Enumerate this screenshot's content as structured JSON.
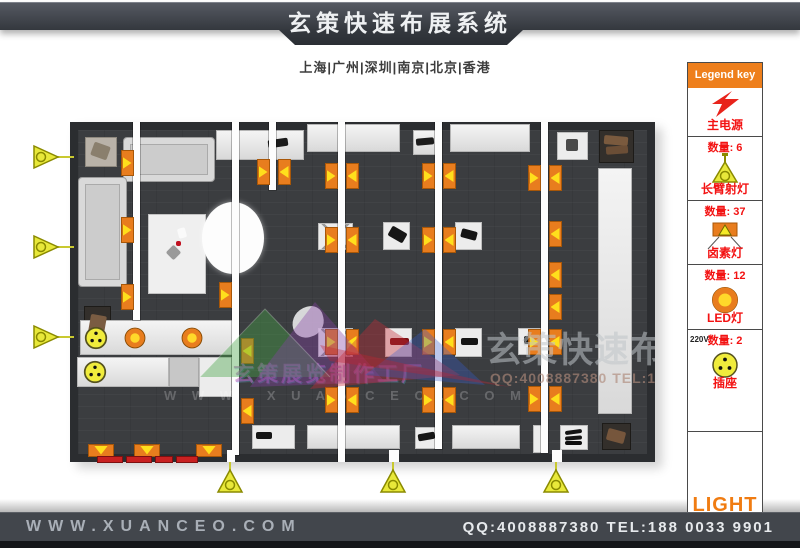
{
  "header": {
    "title": "玄策快速布展系统"
  },
  "subtitle": {
    "cities": "上海|广州|深圳|南京|北京|香港"
  },
  "legend": {
    "title": "Legend key",
    "items": [
      {
        "label": "主电源",
        "icon": "lightning-icon"
      },
      {
        "count": "数量: 6",
        "label": "长臂射灯",
        "icon": "long-arm-spotlight-icon"
      },
      {
        "count": "数量: 37",
        "label": "卤素灯",
        "icon": "halogen-lamp-icon"
      },
      {
        "count": "数量: 12",
        "label": "LED灯",
        "icon": "led-lamp-icon"
      },
      {
        "count": "数量: 2",
        "voltage": "220V",
        "label": "插座",
        "icon": "socket-icon"
      }
    ],
    "footer_label": "LIGHT"
  },
  "watermarks": {
    "studio": "玄策展览制作工厂",
    "url_letters": "W W W . X U A N C E O . C O M",
    "title": "玄策快速布展系统",
    "contact": "QQ:4008887380 TEL:188 003"
  },
  "footer": {
    "website": "WWW.XUANCEO.COM",
    "contact": "QQ:4008887380 TEL:188 0033 9901"
  },
  "colors": {
    "accent_orange": "#ee7f1c",
    "marker_orange": "#e87d1e",
    "marker_yellow": "#ffdf1c",
    "legend_red": "#f31212",
    "bar_dark": "#42464c"
  },
  "plan": {
    "origin": [
      70,
      122
    ],
    "strips": [
      [
        133,
        122,
        7,
        198
      ],
      [
        232,
        122,
        7,
        333
      ],
      [
        269,
        122,
        7,
        68
      ],
      [
        338,
        122,
        7,
        340
      ],
      [
        435,
        122,
        7,
        327
      ],
      [
        541,
        122,
        7,
        331
      ]
    ],
    "halogen_markers": [
      [
        127,
        163,
        "R"
      ],
      [
        127,
        230,
        "R"
      ],
      [
        127,
        297,
        "R"
      ],
      [
        263,
        172,
        "R"
      ],
      [
        284,
        172,
        "L"
      ],
      [
        225,
        295,
        "R"
      ],
      [
        247,
        351,
        "L"
      ],
      [
        247,
        411,
        "L"
      ],
      [
        331,
        176,
        "R"
      ],
      [
        352,
        176,
        "L"
      ],
      [
        331,
        240,
        "R"
      ],
      [
        352,
        240,
        "L"
      ],
      [
        331,
        342,
        "R"
      ],
      [
        352,
        342,
        "L"
      ],
      [
        331,
        400,
        "R"
      ],
      [
        352,
        400,
        "L"
      ],
      [
        428,
        176,
        "R"
      ],
      [
        449,
        176,
        "L"
      ],
      [
        428,
        240,
        "R"
      ],
      [
        449,
        240,
        "L"
      ],
      [
        428,
        342,
        "R"
      ],
      [
        449,
        342,
        "L"
      ],
      [
        428,
        400,
        "R"
      ],
      [
        449,
        400,
        "L"
      ],
      [
        534,
        178,
        "R"
      ],
      [
        555,
        178,
        "L"
      ],
      [
        555,
        234,
        "L"
      ],
      [
        555,
        275,
        "L"
      ],
      [
        555,
        307,
        "L"
      ],
      [
        534,
        342,
        "R"
      ],
      [
        555,
        342,
        "L"
      ],
      [
        534,
        399,
        "R"
      ],
      [
        555,
        399,
        "L"
      ],
      [
        101,
        450,
        "D"
      ],
      [
        147,
        450,
        "D"
      ],
      [
        209,
        450,
        "D"
      ]
    ],
    "furniture": [
      {
        "t": "counter",
        "r": [
          216,
          130,
          88,
          30
        ]
      },
      {
        "t": "counter",
        "r": [
          307,
          124,
          93,
          28
        ]
      },
      {
        "t": "counter",
        "r": [
          413,
          130,
          24,
          25
        ]
      },
      {
        "t": "counter",
        "r": [
          450,
          124,
          80,
          28
        ]
      },
      {
        "t": "white",
        "r": [
          557,
          132,
          31,
          28
        ]
      },
      {
        "t": "dark",
        "r": [
          599,
          130,
          35,
          33
        ]
      },
      {
        "t": "gray",
        "r": [
          85,
          137,
          32,
          30
        ]
      },
      {
        "t": "sofa",
        "r": [
          123,
          137,
          92,
          45
        ]
      },
      {
        "t": "sofa",
        "r": [
          78,
          177,
          49,
          110
        ]
      },
      {
        "t": "dark",
        "r": [
          84,
          306,
          27,
          44
        ]
      },
      {
        "t": "mat",
        "r": [
          148,
          214,
          58,
          80
        ]
      },
      {
        "t": "counter",
        "r": [
          598,
          168,
          34,
          246
        ]
      },
      {
        "t": "pedx",
        "r": [
          318,
          223,
          35,
          27
        ]
      },
      {
        "t": "white",
        "r": [
          383,
          222,
          27,
          28
        ]
      },
      {
        "t": "white",
        "r": [
          455,
          222,
          27,
          28
        ]
      },
      {
        "t": "pedx",
        "r": [
          318,
          328,
          35,
          29
        ]
      },
      {
        "t": "white",
        "r": [
          385,
          328,
          27,
          29
        ]
      },
      {
        "t": "white",
        "r": [
          455,
          328,
          27,
          29
        ]
      },
      {
        "t": "white",
        "r": [
          518,
          328,
          27,
          27
        ]
      },
      {
        "t": "counter",
        "r": [
          80,
          320,
          153,
          35
        ]
      },
      {
        "t": "counter",
        "r": [
          77,
          357,
          92,
          30
        ]
      },
      {
        "t": "lgray",
        "r": [
          169,
          357,
          30,
          30
        ]
      },
      {
        "t": "white",
        "r": [
          199,
          357,
          33,
          40
        ]
      },
      {
        "t": "white",
        "r": [
          252,
          425,
          43,
          24
        ]
      },
      {
        "t": "counter",
        "r": [
          307,
          425,
          93,
          24
        ]
      },
      {
        "t": "white",
        "r": [
          415,
          427,
          25,
          22
        ]
      },
      {
        "t": "counter",
        "r": [
          452,
          425,
          68,
          24
        ]
      },
      {
        "t": "white",
        "r": [
          533,
          425,
          15,
          28
        ]
      },
      {
        "t": "white",
        "r": [
          560,
          425,
          28,
          25
        ]
      },
      {
        "t": "dark",
        "r": [
          602,
          423,
          29,
          27
        ]
      }
    ],
    "items": [
      [
        268,
        139,
        20,
        8,
        -8,
        "#1c1c1c"
      ],
      [
        416,
        138,
        18,
        7,
        -5,
        "#1c1c1c"
      ],
      [
        92,
        144,
        17,
        14,
        20,
        "#8a7f6d"
      ],
      [
        89,
        315,
        16,
        24,
        10,
        "#7a5c42"
      ],
      [
        604,
        136,
        24,
        9,
        5,
        "#7a5a3e"
      ],
      [
        606,
        146,
        22,
        8,
        -4,
        "#6b4e36"
      ],
      [
        566,
        139,
        12,
        12,
        0,
        "#4a4a4a"
      ],
      [
        389,
        229,
        17,
        11,
        30,
        "#161616"
      ],
      [
        461,
        230,
        16,
        9,
        15,
        "#161616"
      ],
      [
        524,
        336,
        16,
        8,
        0,
        "#161616"
      ],
      [
        390,
        338,
        19,
        7,
        0,
        "#7a1216"
      ],
      [
        461,
        338,
        17,
        7,
        0,
        "#161616"
      ],
      [
        256,
        432,
        16,
        7,
        0,
        "#161616"
      ],
      [
        418,
        433,
        17,
        7,
        -10,
        "#161616"
      ],
      [
        565,
        430,
        17,
        4,
        -8,
        "#141414"
      ],
      [
        565,
        436,
        17,
        4,
        -4,
        "#141414"
      ],
      [
        565,
        441,
        17,
        4,
        0,
        "#0e0e0e"
      ],
      [
        607,
        430,
        18,
        12,
        15,
        "#76563c"
      ],
      [
        168,
        247,
        11,
        11,
        45,
        "#9a9a9a"
      ],
      [
        176,
        241,
        5,
        5,
        0,
        "#c01020"
      ],
      [
        178,
        228,
        8,
        10,
        -15,
        "#fafafa"
      ]
    ],
    "sockets": [
      [
        96,
        338
      ],
      [
        95,
        372
      ]
    ],
    "leds": [
      [
        135,
        338
      ],
      [
        192,
        338
      ]
    ],
    "circle": {
      "cx": 233,
      "cy": 238,
      "rx": 31,
      "ry": 36
    },
    "notches": [
      [
        227,
        450,
        8,
        12
      ],
      [
        389,
        450,
        10,
        12
      ],
      [
        552,
        450,
        10,
        12
      ]
    ],
    "red_strips": [
      [
        97,
        456,
        26,
        7
      ],
      [
        126,
        456,
        26,
        7
      ],
      [
        155,
        456,
        18,
        7
      ],
      [
        176,
        456,
        22,
        7
      ]
    ],
    "arms": [
      {
        "side": "left",
        "x": 72,
        "y": 157
      },
      {
        "side": "left",
        "x": 72,
        "y": 247
      },
      {
        "side": "left",
        "x": 72,
        "y": 337
      },
      {
        "side": "bottom",
        "x": 230,
        "y": 462
      },
      {
        "side": "bottom",
        "x": 393,
        "y": 462
      },
      {
        "side": "bottom",
        "x": 556,
        "y": 462
      }
    ]
  }
}
